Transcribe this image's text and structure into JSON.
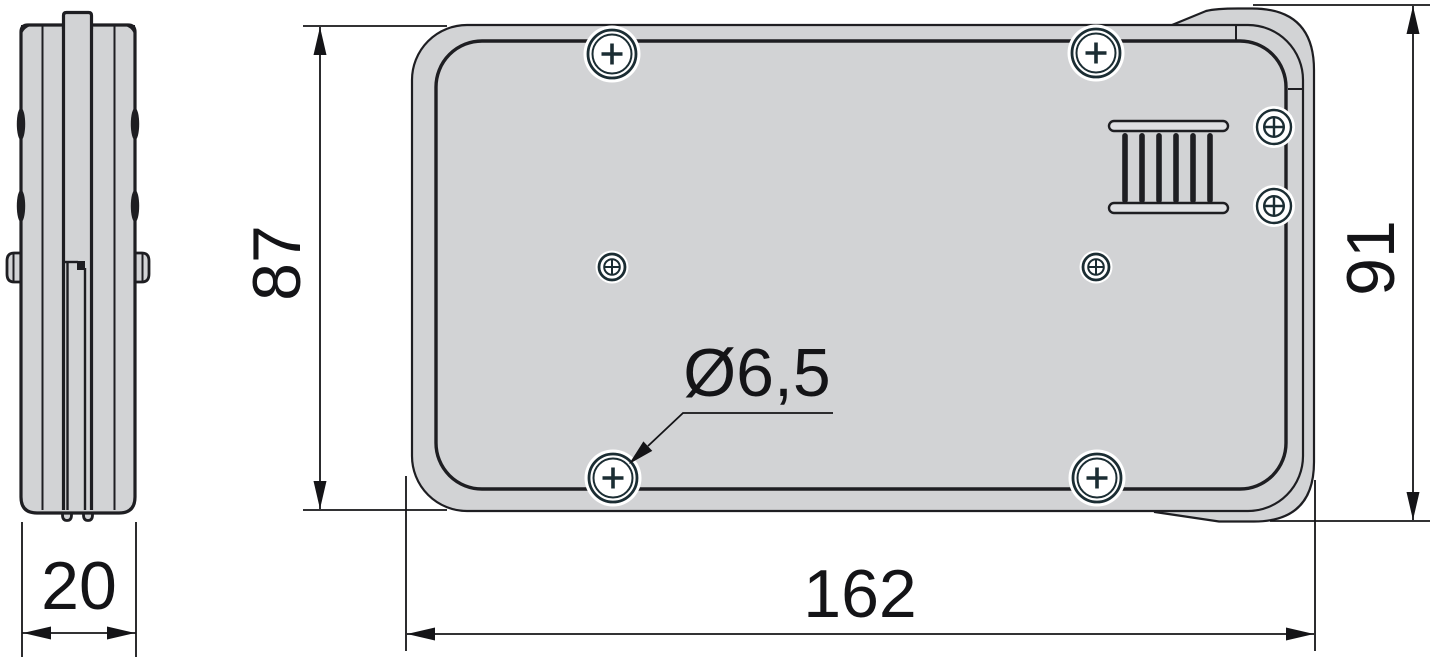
{
  "drawing": {
    "title": "Technical dimension drawing of rounded rectangular enclosure (rear and side views)",
    "colors": {
      "background": "#ffffff",
      "body_fill": "#d2d3d5",
      "outline": "#1e1e22",
      "dim_line": "#141417",
      "screw_outline": "#1b2d33",
      "halo": "#ffffff"
    },
    "views": {
      "side_view": "side profile view",
      "rear_view": "rear view with mounting screws and vent grille"
    },
    "dimensions": {
      "side_width": {
        "label": "20"
      },
      "plate_height": {
        "label": "87"
      },
      "overall_height": {
        "label": "91"
      },
      "overall_width": {
        "label": "162"
      },
      "hole_diameter": {
        "label": "Ø6,5"
      }
    }
  }
}
